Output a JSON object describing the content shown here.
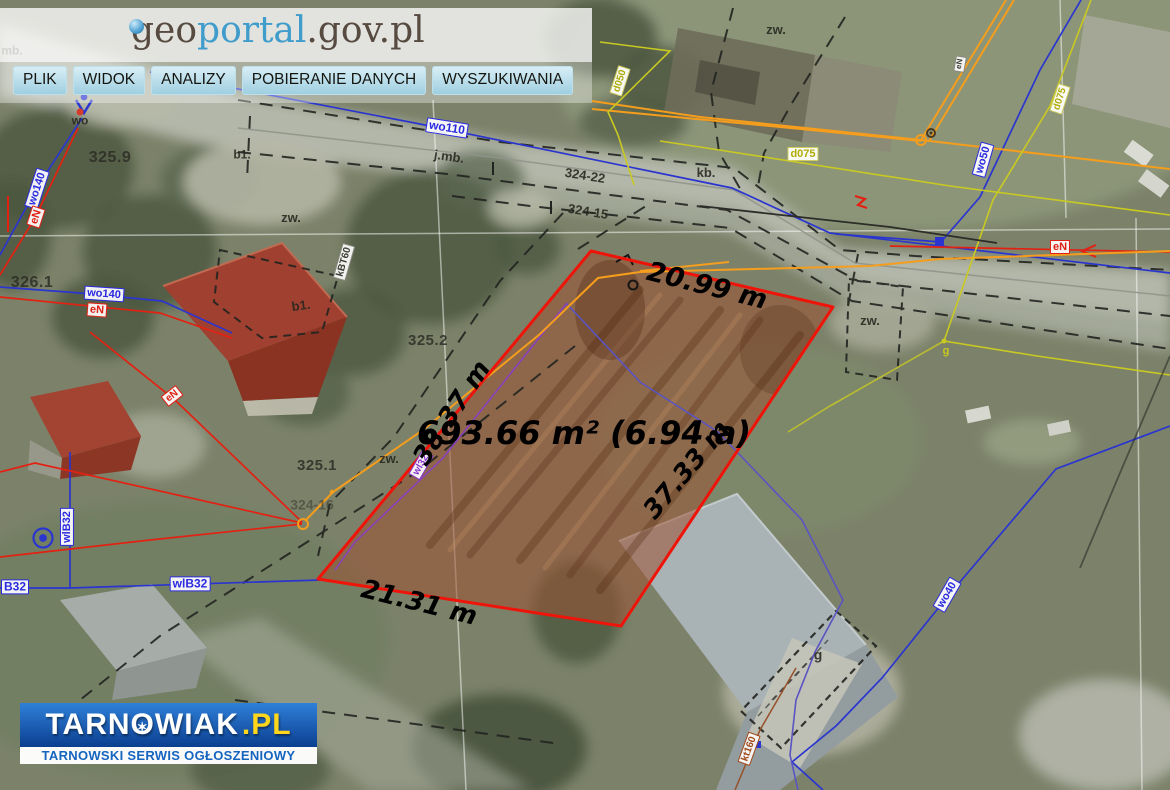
{
  "header": {
    "logo": {
      "geo": "geo",
      "portal": "portal",
      "suffix": ".gov.pl"
    },
    "menu": [
      {
        "label": "PLIK"
      },
      {
        "label": "WIDOK"
      },
      {
        "label": "ANALIZY"
      },
      {
        "label": "POBIERANIE DANYCH"
      },
      {
        "label": "WYSZUKIWANIA"
      }
    ]
  },
  "branding": {
    "name_prefix": "TARN",
    "o": "O",
    "star": "✶",
    "name_suffix": "WIAK",
    "tld": ".PL",
    "tagline": "TARNOWSKI SERWIS OGŁOSZENIOWY"
  },
  "measurements": [
    {
      "id": "side-top",
      "text": "20.99 m",
      "x": 707,
      "y": 286,
      "rot": 14,
      "size": 27
    },
    {
      "id": "side-left",
      "text": "38.37 m",
      "x": 452,
      "y": 413,
      "rot": -57,
      "size": 26
    },
    {
      "id": "area",
      "text": "693.66 m² (6.94 a)",
      "x": 584,
      "y": 433,
      "rot": 0,
      "size": 32
    },
    {
      "id": "side-right",
      "text": "37.33 m",
      "x": 687,
      "y": 470,
      "rot": -50,
      "size": 26
    },
    {
      "id": "side-bottom",
      "text": "21.31 m",
      "x": 419,
      "y": 603,
      "rot": 14,
      "size": 26
    }
  ],
  "map_labels": [
    {
      "text": "mb.",
      "x": 12,
      "y": 51,
      "rot": 0,
      "cls": "dark",
      "size": 12
    },
    {
      "text": "wo",
      "x": 80,
      "y": 121,
      "rot": 0,
      "cls": "dark",
      "size": 12
    },
    {
      "text": "325.9",
      "x": 110,
      "y": 158,
      "rot": 0,
      "cls": "elev",
      "size": 16
    },
    {
      "text": "wo140",
      "x": 37,
      "y": 189,
      "rot": -72,
      "cls": "box-blue",
      "size": 11
    },
    {
      "text": "eN",
      "x": 36,
      "y": 217,
      "rot": -72,
      "cls": "box-red",
      "size": 11
    },
    {
      "text": "326.1",
      "x": 32,
      "y": 283,
      "rot": 0,
      "cls": "elev",
      "size": 16
    },
    {
      "text": "wo140",
      "x": 104,
      "y": 294,
      "rot": 4,
      "cls": "box-blue",
      "size": 11
    },
    {
      "text": "eN",
      "x": 97,
      "y": 310,
      "rot": 4,
      "cls": "box-red",
      "size": 11
    },
    {
      "text": "b1.",
      "x": 242,
      "y": 155,
      "rot": 0,
      "cls": "dark",
      "size": 12
    },
    {
      "text": "zw.",
      "x": 291,
      "y": 218,
      "rot": 0,
      "cls": "dark",
      "size": 13
    },
    {
      "text": "wo110",
      "x": 447,
      "y": 128,
      "rot": 9,
      "cls": "box-blue",
      "size": 12
    },
    {
      "text": "j.mb.",
      "x": 449,
      "y": 157,
      "rot": 8,
      "cls": "dark",
      "size": 13
    },
    {
      "text": "324-22",
      "x": 585,
      "y": 176,
      "rot": 9,
      "cls": "dark",
      "size": 13
    },
    {
      "text": "324-15",
      "x": 588,
      "y": 212,
      "rot": 9,
      "cls": "dark",
      "size": 13
    },
    {
      "text": "kb.",
      "x": 706,
      "y": 173,
      "rot": 0,
      "cls": "dark",
      "size": 13
    },
    {
      "text": "zw.",
      "x": 776,
      "y": 30,
      "rot": 0,
      "cls": "dark",
      "size": 13
    },
    {
      "text": "d050",
      "x": 620,
      "y": 81,
      "rot": -72,
      "cls": "box-yellow",
      "size": 10
    },
    {
      "text": "d075",
      "x": 803,
      "y": 154,
      "rot": 0,
      "cls": "box-yellow",
      "size": 11
    },
    {
      "text": "d075",
      "x": 1060,
      "y": 99,
      "rot": -72,
      "cls": "box-yellow",
      "size": 10
    },
    {
      "text": "wo50",
      "x": 983,
      "y": 160,
      "rot": -74,
      "cls": "box-blue",
      "size": 11
    },
    {
      "text": "eN",
      "x": 960,
      "y": 64,
      "rot": -80,
      "cls": "box-dark",
      "size": 8
    },
    {
      "text": "eN",
      "x": 1060,
      "y": 247,
      "rot": 0,
      "cls": "box-red",
      "size": 11
    },
    {
      "text": "zw.",
      "x": 870,
      "y": 321,
      "rot": 0,
      "cls": "dark",
      "size": 13
    },
    {
      "text": "g",
      "x": 946,
      "y": 351,
      "rot": 0,
      "cls": "yellow",
      "size": 11
    },
    {
      "text": "kBT60",
      "x": 344,
      "y": 262,
      "rot": -74,
      "cls": "box-dark",
      "size": 10
    },
    {
      "text": "b1.",
      "x": 301,
      "y": 306,
      "rot": -8,
      "cls": "dark",
      "size": 13
    },
    {
      "text": "325.2",
      "x": 428,
      "y": 341,
      "rot": 0,
      "cls": "elev",
      "size": 15
    },
    {
      "text": "325.1",
      "x": 317,
      "y": 466,
      "rot": 0,
      "cls": "elev",
      "size": 15
    },
    {
      "text": "zw.",
      "x": 389,
      "y": 459,
      "rot": 0,
      "cls": "dark",
      "size": 13
    },
    {
      "text": "wl32",
      "x": 421,
      "y": 465,
      "rot": -60,
      "cls": "box-purple",
      "size": 10
    },
    {
      "text": "324-16",
      "x": 312,
      "y": 505,
      "rot": 0,
      "cls": "elev-faded",
      "size": 14
    },
    {
      "text": "eN",
      "x": 172,
      "y": 396,
      "rot": -38,
      "cls": "box-red",
      "size": 10
    },
    {
      "text": "wlB32",
      "x": 67,
      "y": 527,
      "rot": -90,
      "cls": "box-blue",
      "size": 11
    },
    {
      "text": "B32",
      "x": 15,
      "y": 587,
      "rot": 0,
      "cls": "box-blue",
      "size": 12
    },
    {
      "text": "wlB32",
      "x": 190,
      "y": 584,
      "rot": 0,
      "cls": "box-blue",
      "size": 12
    },
    {
      "text": "wo40",
      "x": 947,
      "y": 595,
      "rot": -60,
      "cls": "box-blue",
      "size": 11
    },
    {
      "text": "g",
      "x": 818,
      "y": 655,
      "rot": 0,
      "cls": "dark",
      "size": 14
    },
    {
      "text": "kt160",
      "x": 749,
      "y": 749,
      "rot": -70,
      "cls": "box-brown",
      "size": 10
    }
  ],
  "colors": {
    "parcel_outline": "#ee1409",
    "parcel_fill": "#9c5233",
    "menu_button_top": "#d8eef6",
    "logo_blue": "#3f9ccb",
    "logo_brown": "#564a41",
    "brand_blue": "#1565c0",
    "brand_yellow": "#ffd61b",
    "utility_blue": "#2a35cf",
    "utility_red": "#e32112",
    "utility_orange": "#f59d1c",
    "utility_yellow": "#c9c922",
    "utility_purple": "#8a3fc0"
  }
}
